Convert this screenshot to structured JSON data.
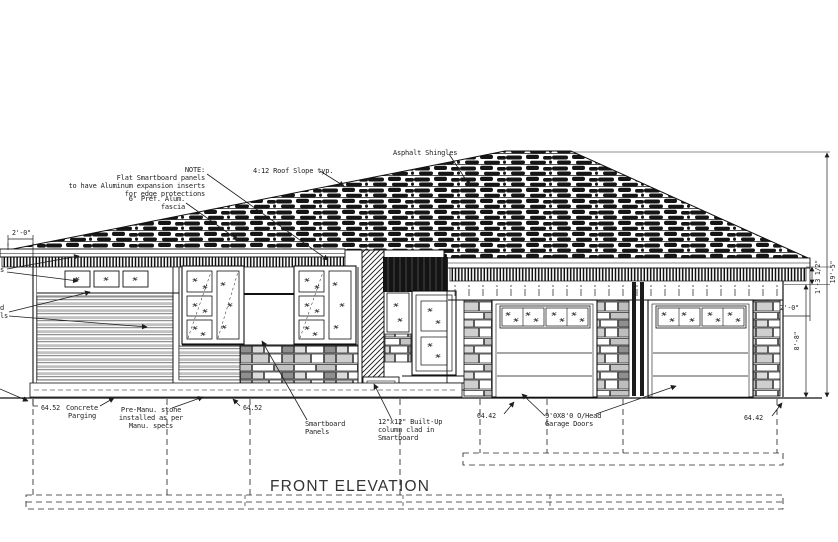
{
  "title": "FRONT ELEVATION",
  "annotations": {
    "note": [
      "NOTE:",
      "Flat Smartboard panels",
      "to have Aluminum expansion inserts",
      "for edge protections"
    ],
    "fascia": [
      "6\" Pref. Alum.",
      "fascia"
    ],
    "roof_slope": "4:12 Roof Slope typ.",
    "shingles": "Asphalt Shingles",
    "parging": [
      "Concrete",
      "Parging"
    ],
    "stone": [
      "Pre-Manu. stone",
      "installed as per",
      "Manu. specs"
    ],
    "smartboard": [
      "Smartboard",
      "Panels"
    ],
    "column": [
      "12\"x12\" Built-Up",
      "column clad in",
      "Smartboard"
    ],
    "garage_doors": [
      "9'0X8'0 O/Head",
      "Garage Doors"
    ],
    "cut_left": [
      "s",
      "d",
      "ls"
    ]
  },
  "dimensions": {
    "left_overhang": "2'-0\"",
    "right_overhang": "2'-0\"",
    "frieze_height": "1'-3 1/2\"",
    "overall_height": "19'-5\"",
    "wall_height": "8'-8\"",
    "elev_main_left": "64.52",
    "elev_main_right": "64.52",
    "elev_garage_left": "64.42",
    "elev_garage_right": "64.42"
  },
  "colors": {
    "line": "#1d1d1d",
    "shingle": "#151515",
    "siding_band": "#c2c2c2",
    "stone_gray": "#bdbdbd",
    "shadow": "#141414",
    "paper": "#ffffff"
  }
}
